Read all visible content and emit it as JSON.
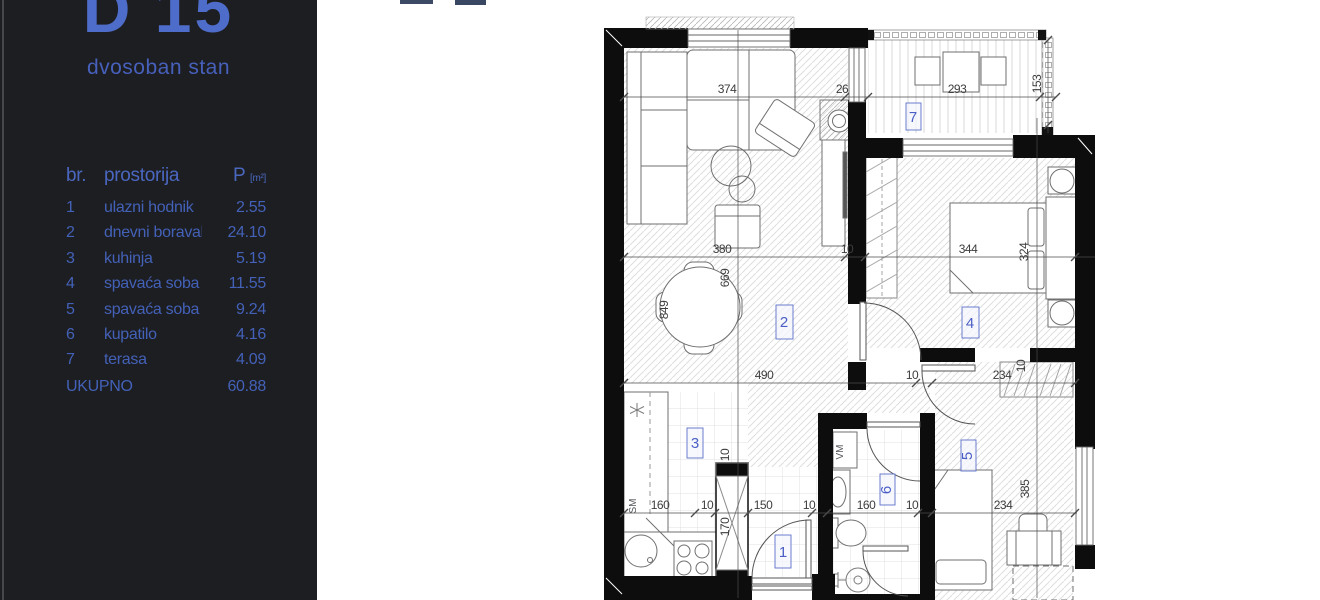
{
  "page": {
    "background": "#ffffff"
  },
  "sidebar": {
    "unit_code": "D 15",
    "unit_type": "dvosoban stan",
    "table": {
      "col_no": "br.",
      "col_room": "prostorija",
      "col_area": "P",
      "col_area_unit": "[m²]",
      "rows": [
        {
          "no": "1",
          "room": "ulazni hodnik",
          "area": "2.55"
        },
        {
          "no": "2",
          "room": "dnevni boravak",
          "area": "24.10"
        },
        {
          "no": "3",
          "room": "kuhinja",
          "area": "5.19"
        },
        {
          "no": "4",
          "room": "spavaća soba",
          "area": "11.55"
        },
        {
          "no": "5",
          "room": "spavaća soba",
          "area": "9.24"
        },
        {
          "no": "6",
          "room": "kupatilo",
          "area": "4.16"
        },
        {
          "no": "7",
          "room": "terasa",
          "area": "4.09"
        }
      ],
      "total_label": "UKUPNO",
      "total_area": "60.88"
    }
  },
  "plan": {
    "rooms": {
      "r1": "1",
      "r2": "2",
      "r3": "3",
      "r4": "4",
      "r5": "5",
      "r6": "6",
      "r7": "7"
    },
    "dims": {
      "top_374": "374",
      "top_26": "26",
      "terrace_293": "293",
      "terrace_153": "153",
      "mid_380": "380",
      "mid_10": "10",
      "bed4_344": "344",
      "bed4_324": "324",
      "dining_669": "669",
      "dining_849": "849",
      "corr_490": "490",
      "corr_10": "10",
      "corr_234": "234",
      "ward5_10": "10",
      "kit_160": "160",
      "kit_10a": "10",
      "kit_150": "150",
      "kit_10b": "10",
      "shaft_10": "10",
      "shaft_170": "170",
      "bath_160": "160",
      "bath_10": "10",
      "low_234": "234",
      "room5_385": "385"
    },
    "appliances": {
      "dishwasher": "SM",
      "washer": "VM"
    }
  },
  "colors": {
    "sidebar_bg": "#1d1e21",
    "accent_blue": "#4a66c0",
    "title_blue": "#4e6cc9",
    "wall": "#0d0d0d",
    "dim_text": "#3d3d3d",
    "fragment_navy": "#3d4a66"
  }
}
